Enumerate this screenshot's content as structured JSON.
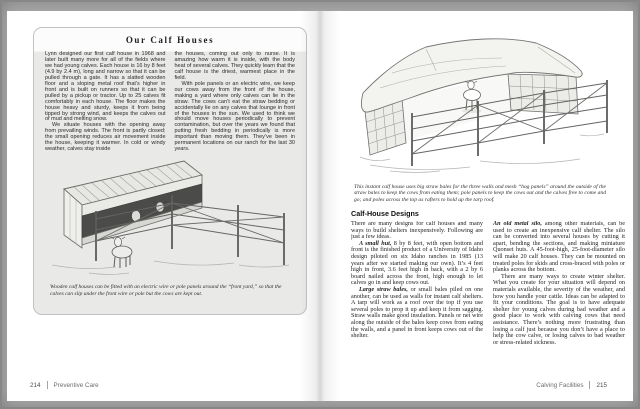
{
  "colors": {
    "surround": "#aaaaaa",
    "page_background": "#ffffff",
    "sidebar_box_background": "#e9e9e8",
    "ink": "#2a2a2a"
  },
  "spread": {
    "left_page": {
      "box": {
        "title": "Our Calf Houses",
        "columns": [
          [
            {
              "indent": false,
              "lead": "",
              "text": "Lynn designed our first calf house in 1968 and later built many more for all of the fields where we had young calves. Each house is 16 by 8 feet (4.9 by 2.4 m), long and narrow so that it can be pulled through a gate. It has a slatted wooden floor and a sloping metal roof that’s higher in front and is built on runners so that it can be pulled by a pickup or tractor. Up to 25 calves fit comfortably in each house. The floor makes the house heavy and sturdy, keeps it from being tipped by strong wind, and keeps the calves out of mud and melting snow."
            },
            {
              "indent": true,
              "lead": "",
              "text": "We situate houses with the opening away from prevailing winds. The front is partly closed; the small opening reduces air movement inside the house, keeping it warmer. In cold or windy weather, calves stay inside"
            }
          ],
          [
            {
              "indent": false,
              "lead": "",
              "text": "the houses, coming out only to nurse. It is amazing how warm it is inside, with the body heat of several calves. They quickly learn that the calf house is the driest, warmest place in the field."
            },
            {
              "indent": true,
              "lead": "",
              "text": "With pole panels or an electric wire, we keep our cows away from the front of the house, making a yard where only calves can lie in the straw. The cows can’t eat the straw bedding or accidentally lie on any calves that lounge in front of the houses in the sun. We used to think we should move houses periodically to prevent contamination, but over the years we found that putting fresh bedding in periodically is more important than moving them. They’ve been in permanent locations on our ranch for the last 30 years."
            }
          ]
        ],
        "caption": "Wooden calf houses can be fitted with an electric wire or pole panels around the “front yard,” so that the calves can slip under the front wire or pole but the cows are kept out."
      },
      "footer": {
        "page_number": "214",
        "section": "Preventive Care"
      }
    },
    "right_page": {
      "illustration_caption": "This instant calf house uses big straw bales for the three walls and mesh “hog panels” around the outside of the straw bales to keep the cows from eating them; pole panels to keep the cows out and the calves free to come and go; and poles across the top as rafters to hold up the tarp roof.",
      "heading": "Calf-House Designs",
      "columns": [
        [
          {
            "indent": false,
            "lead": "",
            "text": "There are many designs for calf houses and many ways to build shelters inexpensively. Following are just a few ideas."
          },
          {
            "indent": true,
            "lead": "A small hut,",
            "text": "8 by 8 feet, with open bottom and front is the finished product of a University of Idaho design piloted on six Idaho ranches in 1985 (13 years after we started making our own). It’s 4 feet high in front, 3.6 feet high in back, with a 2 by 6 board nailed across the front, high enough to let calves go in and keep cows out."
          },
          {
            "indent": true,
            "lead": "Large straw bales,",
            "text": "or small bales piled on one another, can be used as walls for instant calf shelters. A tarp will work as a roof over the top if you use several poles to prop it up and keep it from sagging. Straw walls make good insulation. Panels or net wire along the outside of the bales keep cows from eating the walls, and a panel in front keeps cows out of the shelter."
          }
        ],
        [
          {
            "indent": false,
            "lead": "An old metal silo,",
            "text": "among other materials, can be used to create an inexpensive calf shelter. The silo can be converted into several houses by cutting it apart, bending the sections, and making miniature Quonset huts. A 45-foot-high, 25-foot-diameter silo will make 20 calf houses. They can be mounted on treated poles for skids and cross-braced with poles or planks across the bottom."
          },
          {
            "indent": true,
            "lead": "",
            "text": "There are many ways to create winter shelter. What you create for your situation will depend on materials available, the severity of the weather, and how you handle your cattle. Ideas can be adapted to fit your conditions. The goal is to have adequate shelter for young calves during bad weather and a good place to work with calving cows that need assistance. There’s nothing more frustrating than losing a calf just because you don’t have a place to help the cow calve, or losing calves to bad weather or stress-related sickness."
          }
        ]
      ],
      "footer": {
        "section": "Calving Facilities",
        "page_number": "215"
      }
    }
  }
}
